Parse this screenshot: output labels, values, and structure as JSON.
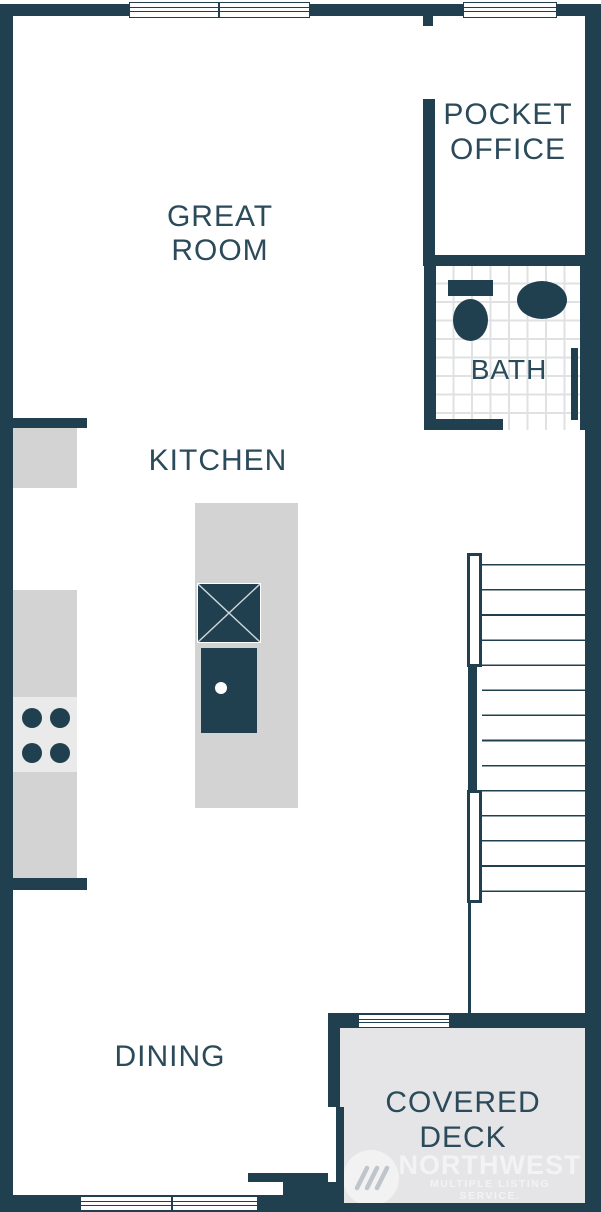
{
  "labels": {
    "great_room": {
      "line1": "GREAT",
      "line2": "ROOM"
    },
    "pocket_office": {
      "line1": "POCKET",
      "line2": "OFFICE"
    },
    "bath": "BATH",
    "kitchen": "KITCHEN",
    "dining": "DINING",
    "covered_deck": {
      "line1": "COVERED",
      "line2": "DECK"
    }
  },
  "watermark": {
    "brand": "NORTHWEST",
    "tagline": "MULTIPLE LISTING SERVICE."
  },
  "colors": {
    "wall": "#21404f",
    "room_text": "#2b4a5a",
    "counter_gray": "#d3d3d3",
    "appliance_gray": "#eaeaea",
    "deck_gray": "#e5e5e7",
    "tile_grout": "#dfe1e2",
    "background": "#ffffff"
  }
}
